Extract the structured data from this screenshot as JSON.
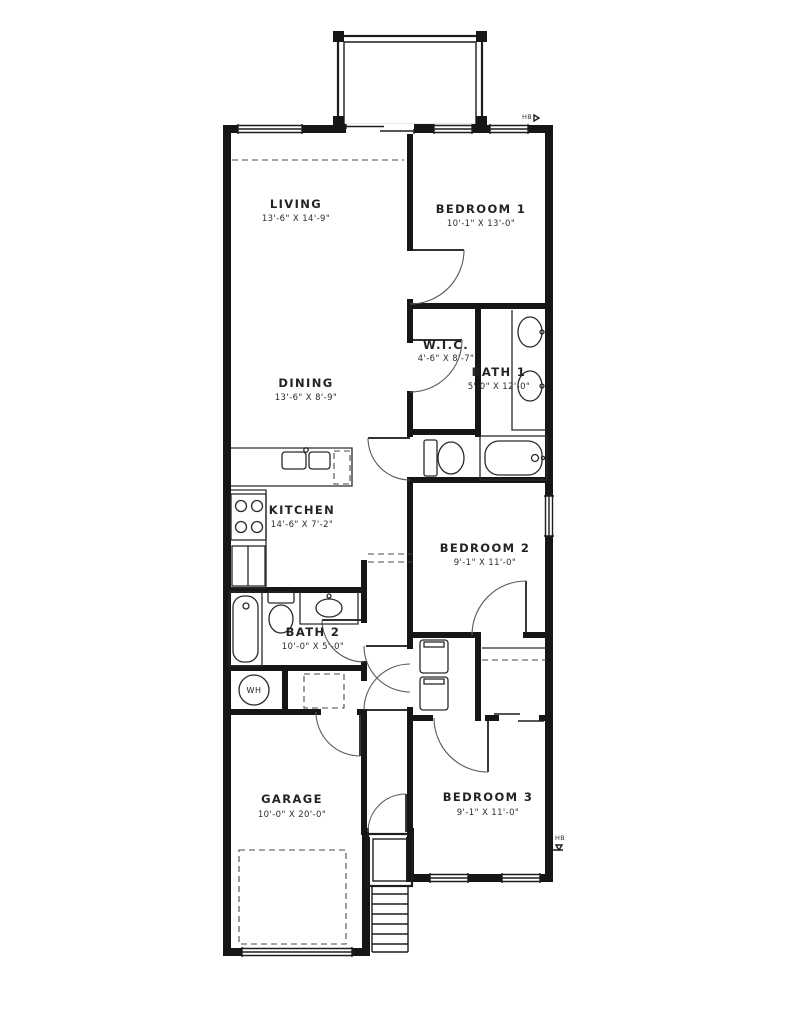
{
  "plan": {
    "rooms": {
      "living": {
        "name": "LIVING",
        "dims": "13'-6\" X 14'-9\""
      },
      "dining": {
        "name": "DINING",
        "dims": "13'-6\" X 8'-9\""
      },
      "kitchen": {
        "name": "KITCHEN",
        "dims": "14'-6\" X 7'-2\""
      },
      "bedroom1": {
        "name": "BEDROOM 1",
        "dims": "10'-1\" X 13'-0\""
      },
      "bedroom2": {
        "name": "BEDROOM 2",
        "dims": "9'-1\" X 11'-0\""
      },
      "bedroom3": {
        "name": "BEDROOM 3",
        "dims": "9'-1\" X 11'-0\""
      },
      "bath1": {
        "name": "BATH 1",
        "dims": "5'-0\" X 12'-0\""
      },
      "bath2": {
        "name": "BATH 2",
        "dims": "10'-0\" X 5'-0\""
      },
      "wic": {
        "name": "W.I.C.",
        "dims": "4'-6\" X 8'-7\""
      },
      "garage": {
        "name": "GARAGE",
        "dims": "10'-0\" X 20'-0\""
      }
    },
    "labels": {
      "water_heater": "WH",
      "hose_bib_top": "HB",
      "hose_bib_right": "HB"
    },
    "colors": {
      "wall": "#161616",
      "line": "#2a2a2a",
      "text": "#232323",
      "background": "#ffffff"
    }
  }
}
